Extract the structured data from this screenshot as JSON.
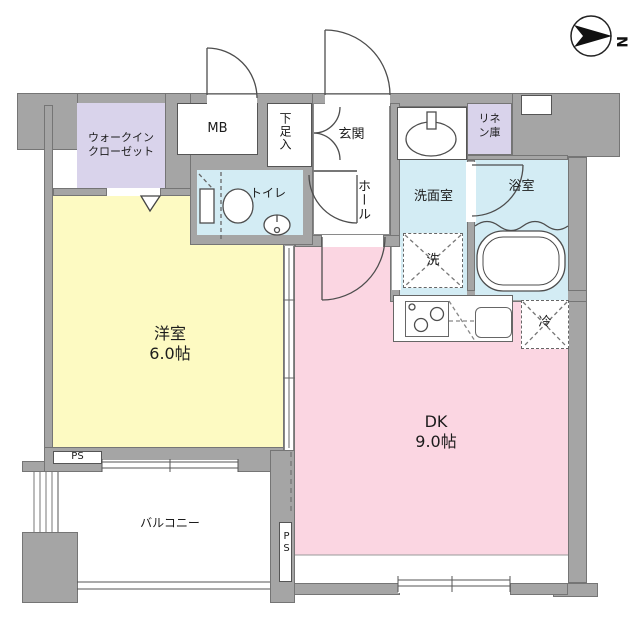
{
  "plan_title": "1DK apartment floor plan",
  "compass": {
    "north_label": "N"
  },
  "colors": {
    "wall": "#a5a5a5",
    "western_room_fill": "#fdfac2",
    "dk_fill": "#fbd6e2",
    "closet_fill": "#d9d3eb",
    "wet_area_fill": "#d3ecf4",
    "outline": "#4d4d4d"
  },
  "rooms": {
    "wic": {
      "label": "ウォークイン\nクローゼット"
    },
    "mb": {
      "label": "MB"
    },
    "shoe_box": {
      "label": "下足入"
    },
    "entrance": {
      "label": "玄関"
    },
    "linen": {
      "label": "リネ\nン庫"
    },
    "toilet": {
      "label": "トイレ"
    },
    "hall": {
      "label": "ホール"
    },
    "washroom": {
      "label": "洗面室"
    },
    "bathroom": {
      "label": "浴室"
    },
    "washer": {
      "label": "洗"
    },
    "fridge": {
      "label": "冷"
    },
    "western_room": {
      "label": "洋室\n6.0帖"
    },
    "dk": {
      "label": "DK\n9.0帖"
    },
    "balcony": {
      "label": "バルコニー"
    },
    "ps_bottom_left": {
      "label": "PS"
    },
    "ps_balcony": {
      "label": "PS"
    }
  }
}
